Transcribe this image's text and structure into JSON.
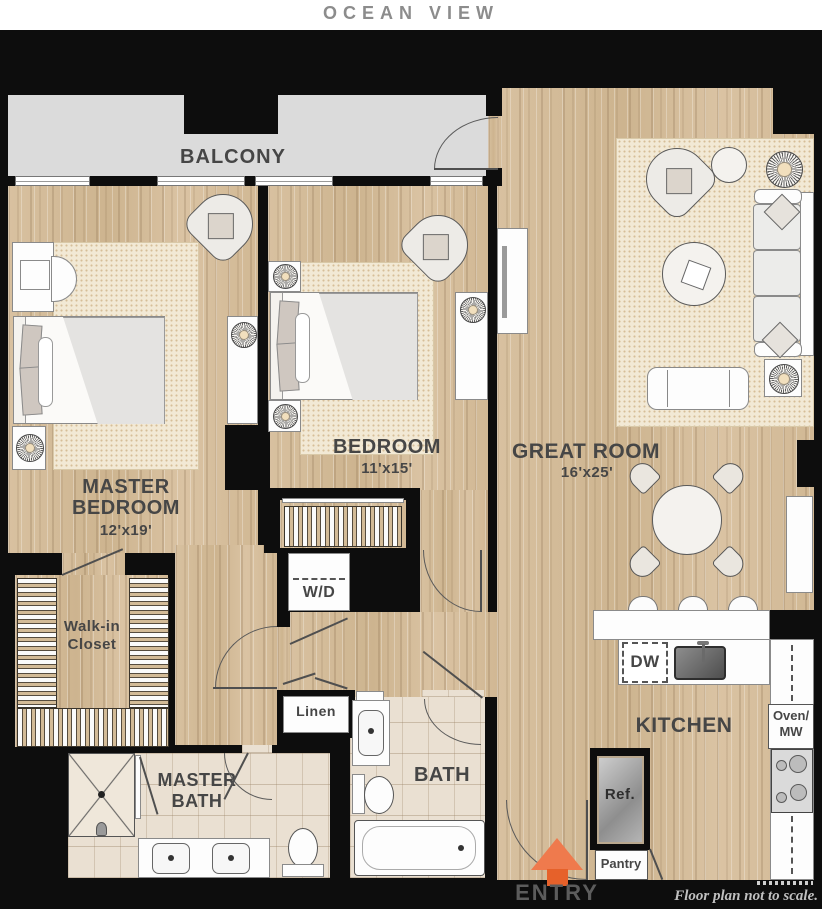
{
  "title": "OCEAN VIEW",
  "footnote": "Floor plan not to scale.",
  "rooms": {
    "balcony": {
      "label": "BALCONY"
    },
    "master_bedroom": {
      "line1": "MASTER",
      "line2": "BEDROOM",
      "dims": "12'x19'"
    },
    "bedroom": {
      "label": "BEDROOM",
      "dims": "11'x15'"
    },
    "great_room": {
      "label": "GREAT ROOM",
      "dims": "16'x25'"
    },
    "kitchen": {
      "label": "KITCHEN"
    },
    "bath": {
      "label": "BATH"
    },
    "master_bath": {
      "line1": "MASTER",
      "line2": "BATH"
    },
    "walk_in_closet": {
      "line1": "Walk-in",
      "line2": "Closet"
    },
    "entry": {
      "label": "ENTRY"
    }
  },
  "fixtures": {
    "washer_dryer": "W/D",
    "linen": "Linen",
    "dishwasher": "DW",
    "refrigerator": "Ref.",
    "pantry": "Pantry",
    "oven_line1": "Oven/",
    "oven_line2": "MW"
  },
  "colors": {
    "wall": "#0d0d0d",
    "wood_floor": "#d5bd9c",
    "tile_floor": "#eae0d2",
    "rug": "#f2e9d5",
    "balcony": "#dbdbdb",
    "entry_arrow": "#ef7a4d",
    "entry_arrow_stem": "#e6612a",
    "title_gray": "#8c8c8c",
    "label_gray": "#464646"
  }
}
